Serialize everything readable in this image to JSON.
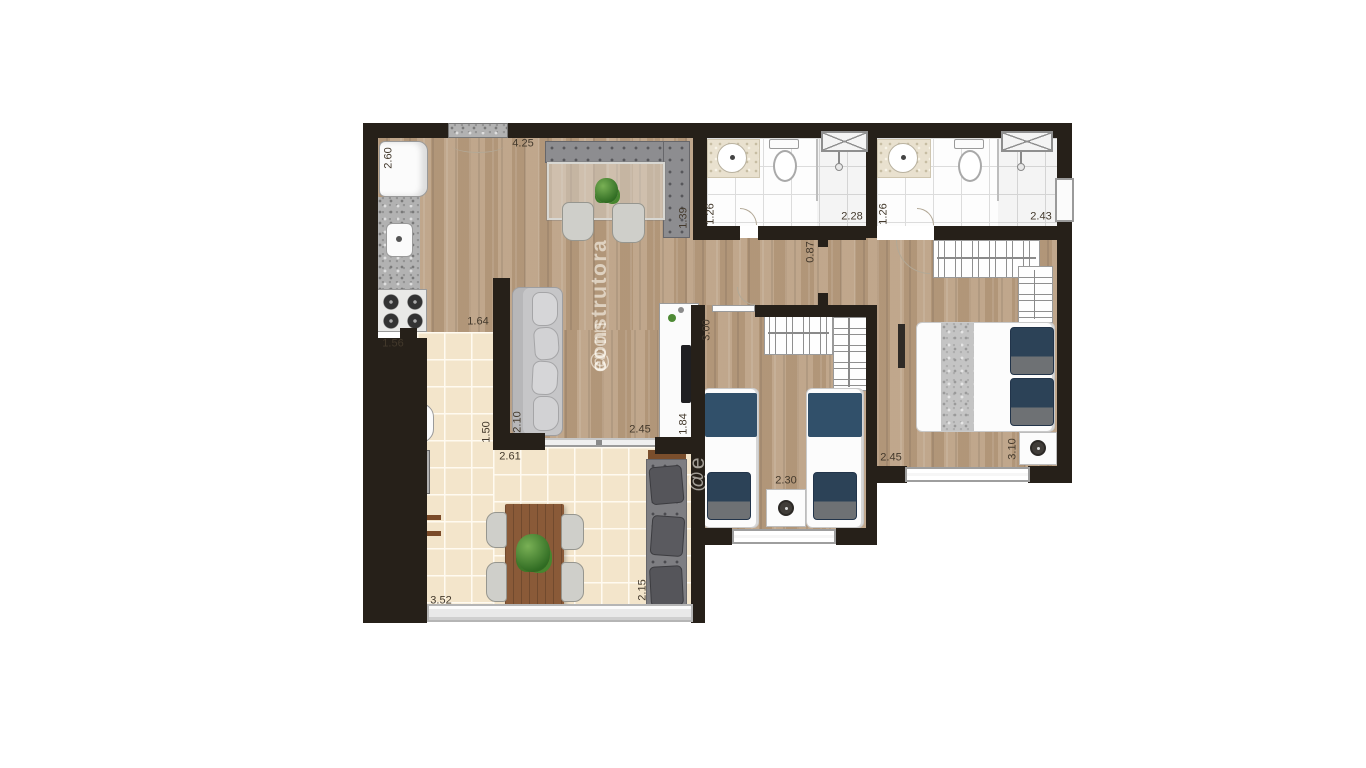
{
  "watermark": {
    "at": "@",
    "brand_light": "econ",
    "brand_bold": "construtora",
    "fragment": "@e"
  },
  "dims": {
    "fridge_wall": "2.60",
    "kitchen_dining_width": "4.25",
    "dining_bench_depth": "1.39",
    "bath1_width": "1.26",
    "bath1_length": "2.28",
    "bath2_width": "1.26",
    "bath2_length": "2.43",
    "hall_width": "0.87",
    "bedroom2_length": "3.00",
    "kitchen_opening": "1.64",
    "laundry_width": "1.56",
    "sofa_wall": "2.10",
    "service_opening": "1.50",
    "terrace_width": "2.61",
    "living_door_width": "2.45",
    "tv_wall": "1.84",
    "bedroom1_width": "2.45",
    "bedroom1_length": "3.10",
    "bedroom2_width": "2.30",
    "terrace_bench_length": "2.15",
    "terrace_length": "3.52"
  },
  "colors": {
    "wall": "#262019",
    "wood_floor": "#bba083",
    "terrace_tile": "#f3e5cb",
    "bath_tile": "#fdfdfd",
    "bed_accent_navy": "#31506a",
    "upholstery_gray": "#8d8d90",
    "table_wood": "#8a5a38"
  }
}
